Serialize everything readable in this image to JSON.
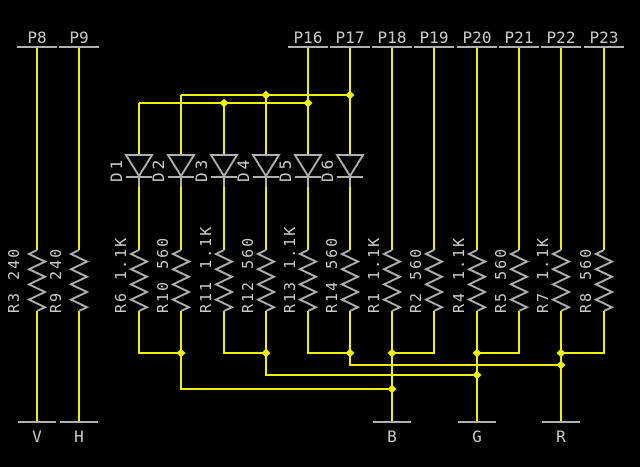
{
  "colors": {
    "background": "#000000",
    "wire": "#f0f000",
    "symbol": "#b0b0b0",
    "text": "#c9c9c9"
  },
  "pins": [
    {
      "label": "P8"
    },
    {
      "label": "P9"
    },
    {
      "label": "P16"
    },
    {
      "label": "P17"
    },
    {
      "label": "P18"
    },
    {
      "label": "P19"
    },
    {
      "label": "P20"
    },
    {
      "label": "P21"
    },
    {
      "label": "P22"
    },
    {
      "label": "P23"
    }
  ],
  "diodes": [
    {
      "label": "D1"
    },
    {
      "label": "D2"
    },
    {
      "label": "D3"
    },
    {
      "label": "D4"
    },
    {
      "label": "D5"
    },
    {
      "label": "D6"
    }
  ],
  "resistors": [
    {
      "label": "R3 240"
    },
    {
      "label": "R9 240"
    },
    {
      "label": "R6 1.1K"
    },
    {
      "label": "R10 560"
    },
    {
      "label": "R11 1.1K"
    },
    {
      "label": "R12 560"
    },
    {
      "label": "R13 1.1K"
    },
    {
      "label": "R14 560"
    },
    {
      "label": "R1 1.1K"
    },
    {
      "label": "R2 560"
    },
    {
      "label": "R4 1.1K"
    },
    {
      "label": "R5 560"
    },
    {
      "label": "R7 1.1K"
    },
    {
      "label": "R8 560"
    }
  ],
  "grounds": [
    {
      "label": "V"
    },
    {
      "label": "H"
    },
    {
      "label": "B"
    },
    {
      "label": "G"
    },
    {
      "label": "R"
    }
  ]
}
